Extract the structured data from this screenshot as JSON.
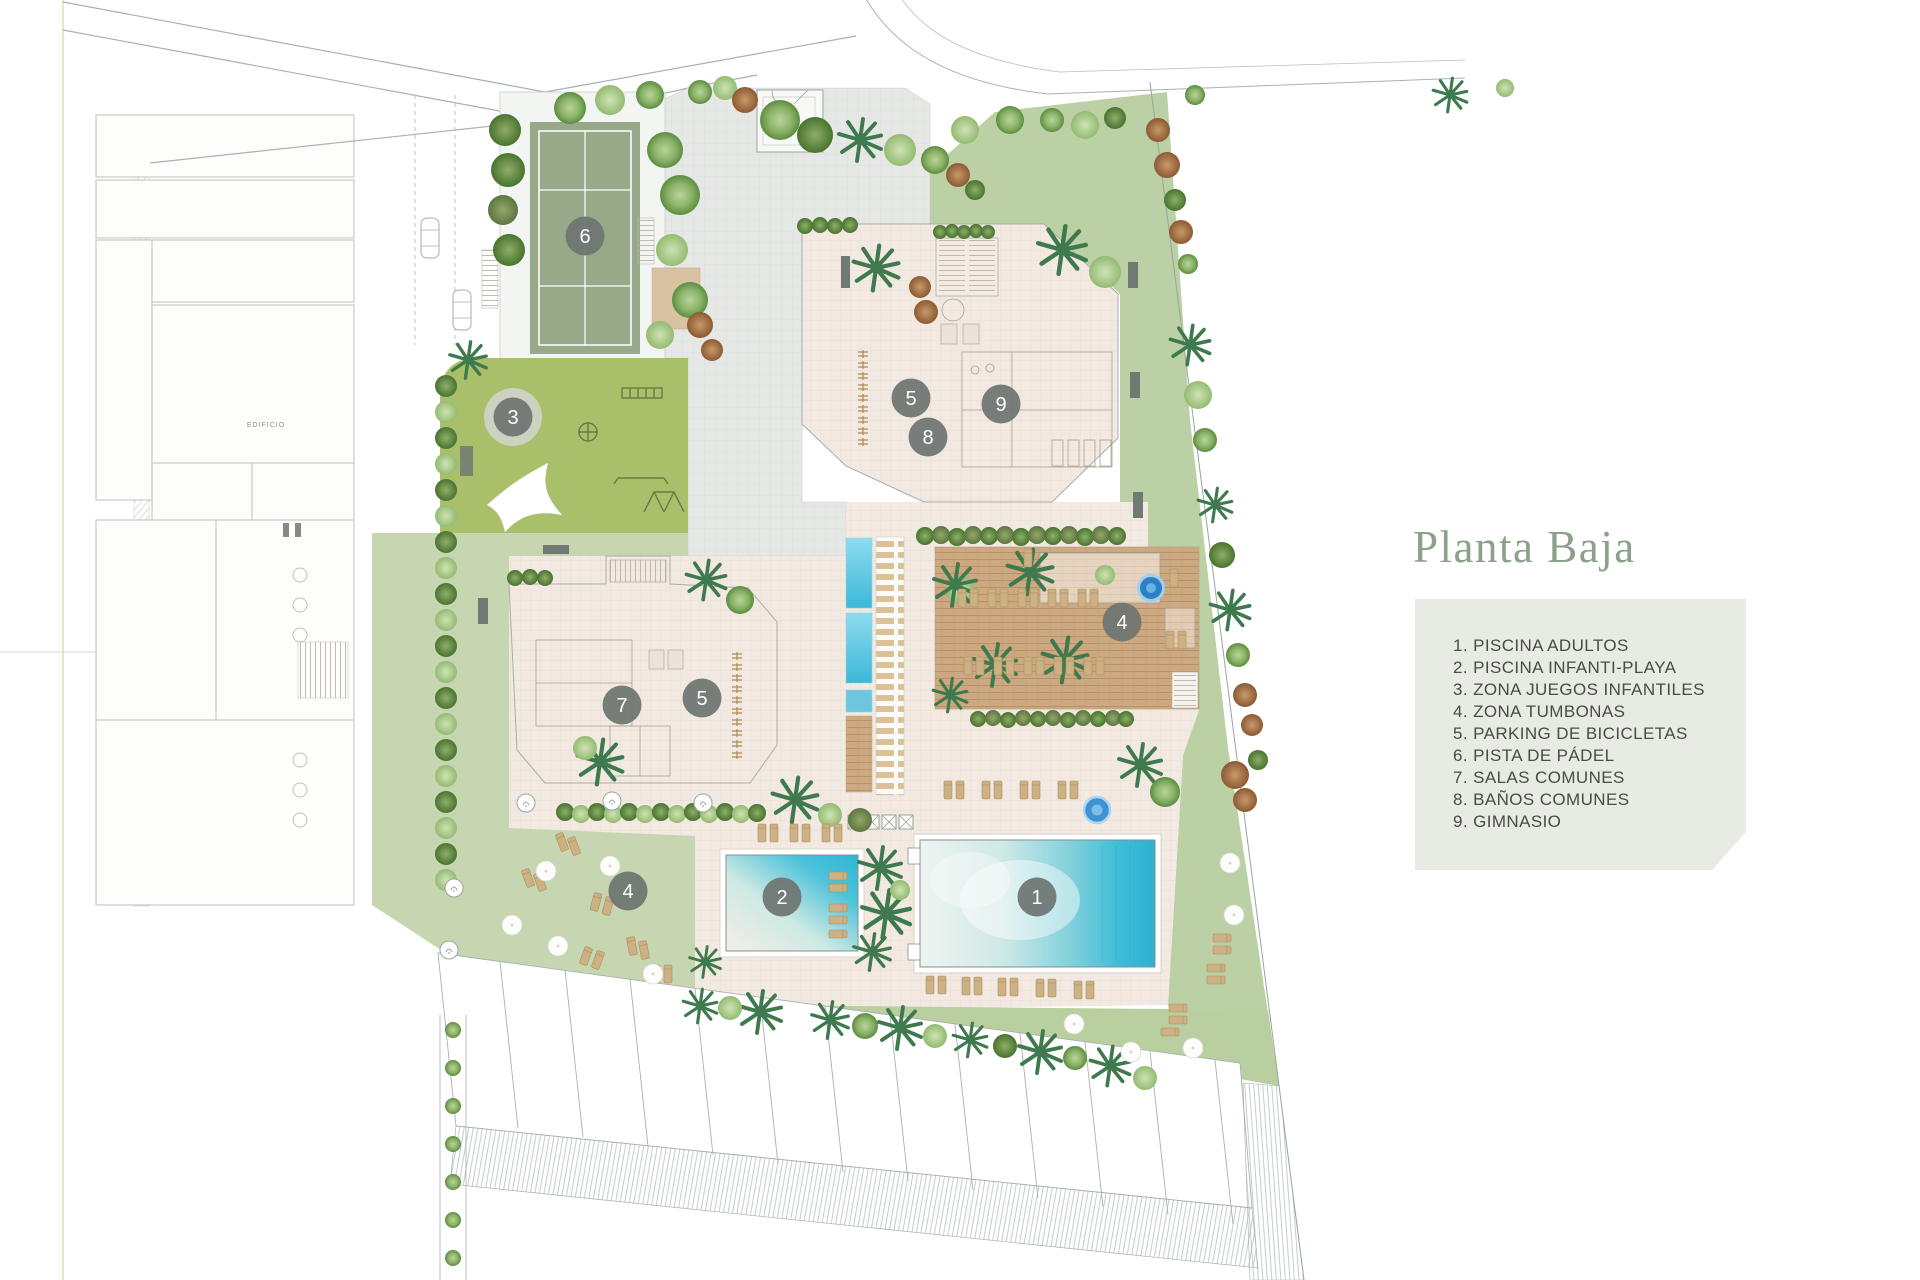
{
  "title": {
    "text": "Planta Baja"
  },
  "legend": {
    "items": [
      "1. PISCINA ADULTOS",
      "2. PISCINA INFANTI-PLAYA",
      "3. ZONA JUEGOS INFANTILES",
      "4. ZONA TUMBONAS",
      "5. PARKING DE BICICLETAS",
      "6. PISTA DE PÁDEL",
      "7. SALAS COMUNES",
      "8. BAÑOS COMUNES",
      "9. GIMNASIO"
    ]
  },
  "plan": {
    "neighbor_label": "EDIFICIO",
    "markers": [
      {
        "n": "6",
        "x": 585,
        "y": 236
      },
      {
        "n": "3",
        "x": 513,
        "y": 417,
        "ring": true
      },
      {
        "n": "5",
        "x": 911,
        "y": 398
      },
      {
        "n": "9",
        "x": 1001,
        "y": 404
      },
      {
        "n": "8",
        "x": 928,
        "y": 437
      },
      {
        "n": "7",
        "x": 622,
        "y": 705
      },
      {
        "n": "5",
        "x": 702,
        "y": 698
      },
      {
        "n": "4",
        "x": 1122,
        "y": 622
      },
      {
        "n": "4",
        "x": 628,
        "y": 891
      },
      {
        "n": "2",
        "x": 782,
        "y": 897
      },
      {
        "n": "1",
        "x": 1037,
        "y": 897
      }
    ]
  },
  "colors": {
    "title_text": "#8ba189",
    "legend_bg": "#e7ebe3",
    "legend_text": "#474c44",
    "marker": "#6e7571",
    "marker_ring": "#ccd1c0",
    "pool_water": "#35bbd6",
    "lawn": "#bcd0a5",
    "padel_court": "#98a98a",
    "playground": "#aabf69",
    "deck_wood": "#cda983",
    "paving": "#e6e8e5",
    "building": "#f1e8e0"
  }
}
